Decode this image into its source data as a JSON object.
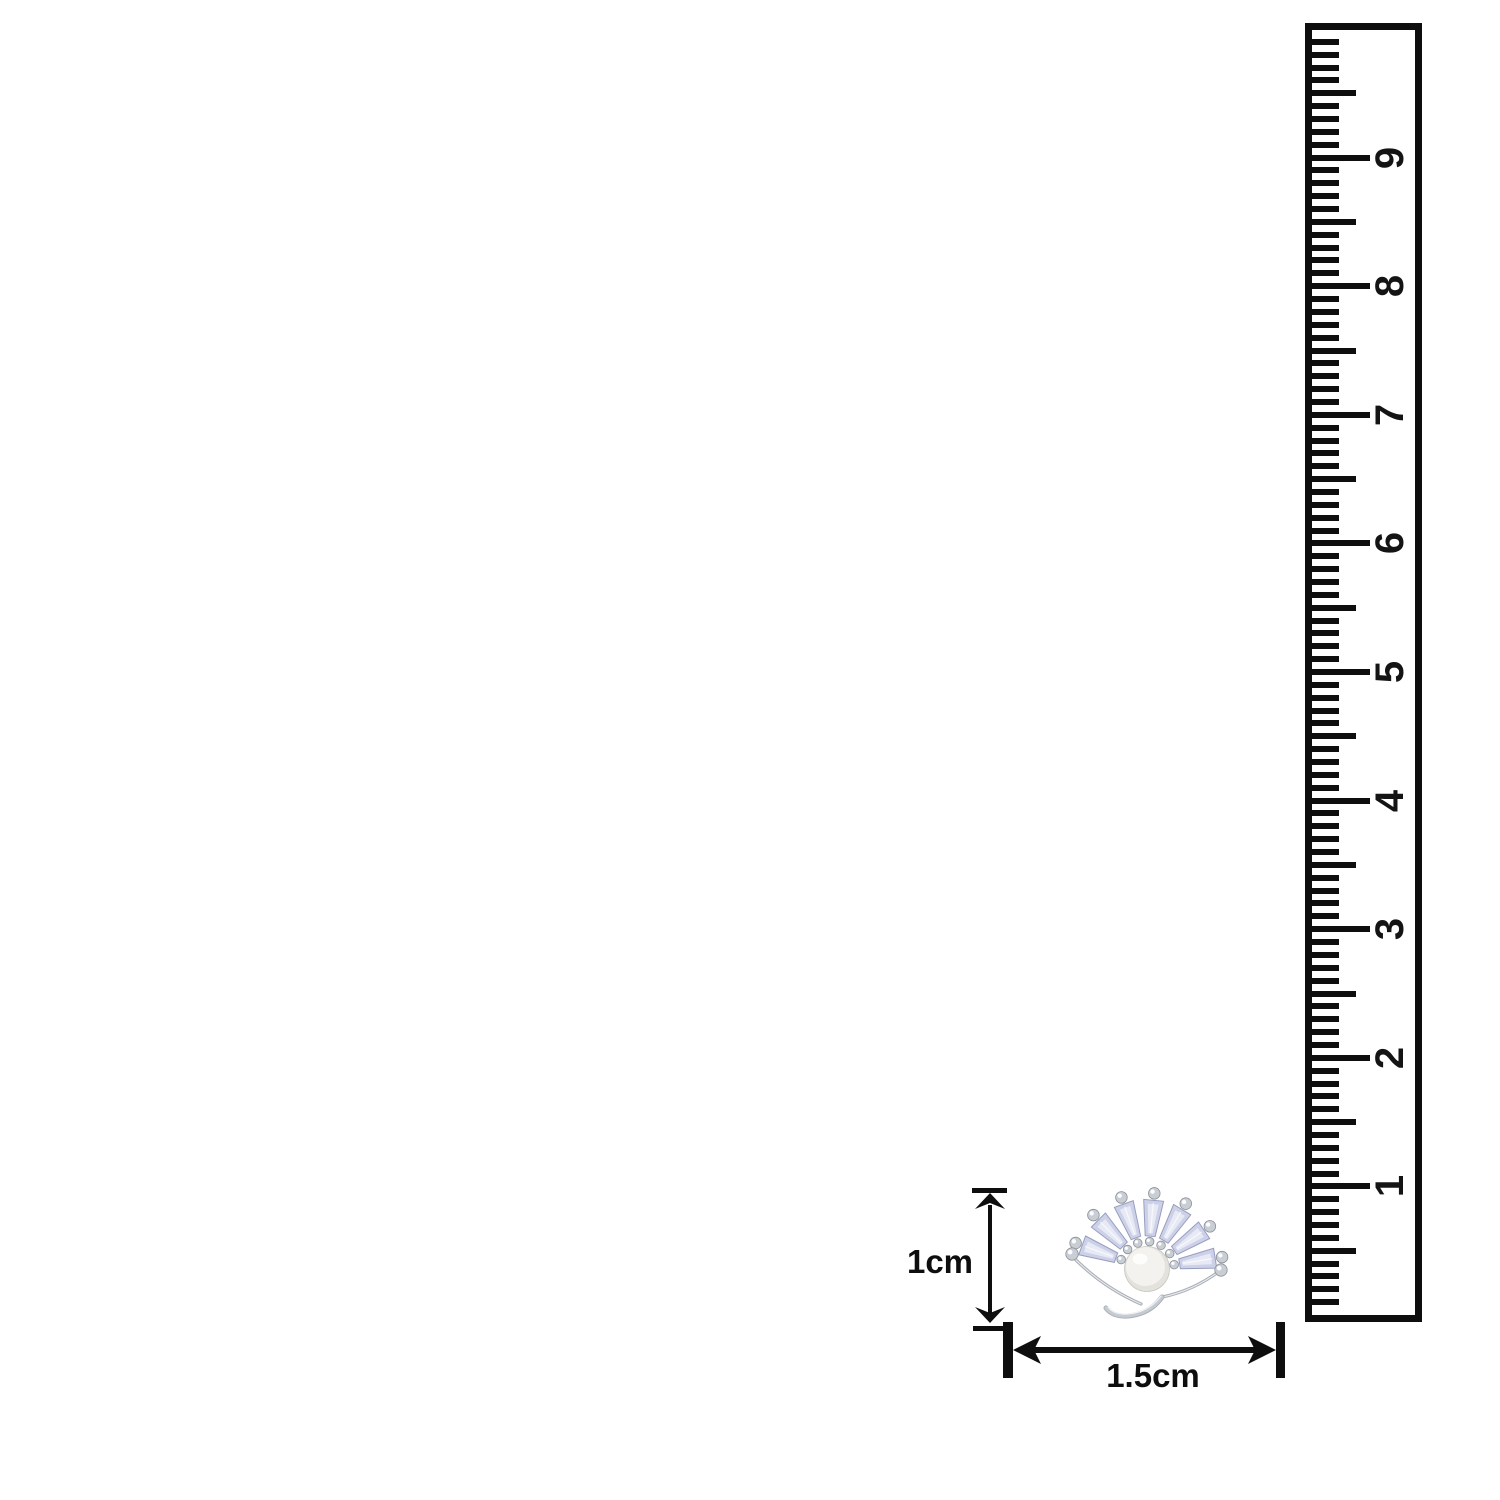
{
  "canvas": {
    "background": "#ffffff",
    "ink_color": "#0e0e0e"
  },
  "ruler": {
    "numbers": [
      "1",
      "2",
      "3",
      "4",
      "5",
      "6",
      "7",
      "8",
      "9"
    ],
    "ink_color": "#0e0e0e"
  },
  "dimensions": {
    "height_label": "1cm",
    "width_label": "1.5cm",
    "ink_color": "#0e0e0e"
  },
  "jewelry": {
    "colors": {
      "metal": "#a9aeb7",
      "metal_light": "#e9ebee",
      "stone": "#cdd1e8",
      "stone_light": "#e7e9f5",
      "stone_edge": "#989dc0",
      "bead": "#c9cdd4",
      "bead_edge": "#8a9098",
      "pearl": "#f3f2ee",
      "pearl_shade": "#e4e2dd"
    }
  }
}
